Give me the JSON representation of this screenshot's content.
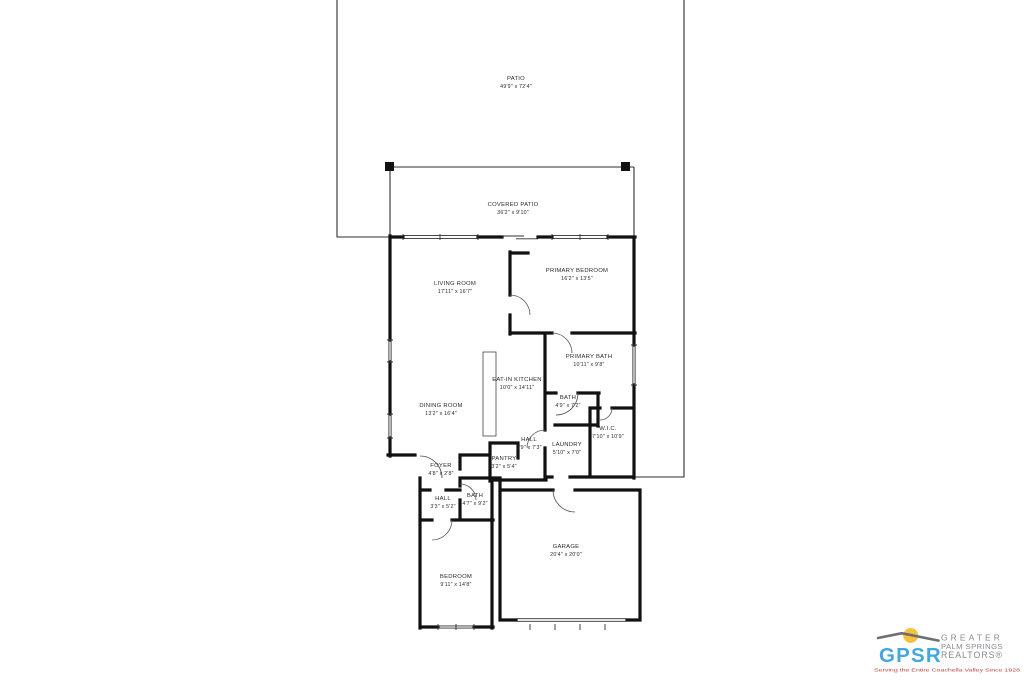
{
  "page": {
    "background_color": "#ffffff"
  },
  "floorplan": {
    "wall_color": "#111111",
    "rooms": [
      {
        "id": "patio",
        "name": "PATIO",
        "dims": "49'9\" x 72'4\""
      },
      {
        "id": "covered-patio",
        "name": "COVERED PATIO",
        "dims": "36'2\" x 9'10\""
      },
      {
        "id": "living-room",
        "name": "LIVING ROOM",
        "dims": "17'11\" x 16'7\""
      },
      {
        "id": "primary-bedroom",
        "name": "PRIMARY BEDROOM",
        "dims": "16'2\" x 13'5\""
      },
      {
        "id": "primary-bath",
        "name": "PRIMARY BATH",
        "dims": "10'11\" x 9'8\""
      },
      {
        "id": "eat-in-kitchen",
        "name": "EAT-IN KITCHEN",
        "dims": "10'0\" x 14'11\""
      },
      {
        "id": "bath-upper",
        "name": "BATH",
        "dims": "4'9\" x 7'2\""
      },
      {
        "id": "dining-room",
        "name": "DINING ROOM",
        "dims": "13'2\" x 16'4\""
      },
      {
        "id": "hall-upper",
        "name": "HALL",
        "dims": "3'9\" x 7'3\""
      },
      {
        "id": "pantry",
        "name": "PANTRY",
        "dims": "3'2\" x 5'4\""
      },
      {
        "id": "laundry",
        "name": "LAUNDRY",
        "dims": "5'10\" x 7'0\""
      },
      {
        "id": "wic",
        "name": "W.I.C.",
        "dims": "7'10\" x 10'9\""
      },
      {
        "id": "foyer",
        "name": "FOYER",
        "dims": "4'8\" x 2'8\""
      },
      {
        "id": "hall-lower",
        "name": "HALL",
        "dims": "3'3\" x 5'2\""
      },
      {
        "id": "bath-lower",
        "name": "BATH",
        "dims": "4'7\" x 9'2\""
      },
      {
        "id": "bedroom",
        "name": "BEDROOM",
        "dims": "9'11\" x 14'8\""
      },
      {
        "id": "garage",
        "name": "GARAGE",
        "dims": "20'4\" x 20'0\""
      }
    ]
  },
  "logo": {
    "acronym": "GPSR",
    "line1": "GREATER",
    "line2": "PALM SPRINGS",
    "line3": "REALTORS®",
    "tagline": "Serving the Entire Coachella Valley Since 1928",
    "colors": {
      "acronym_blue": "#45a8dc",
      "text_gray": "#87898c",
      "roof_gray": "#6d6e71",
      "sun_yellow": "#f9c23c",
      "tagline_red": "#b9443e"
    }
  }
}
